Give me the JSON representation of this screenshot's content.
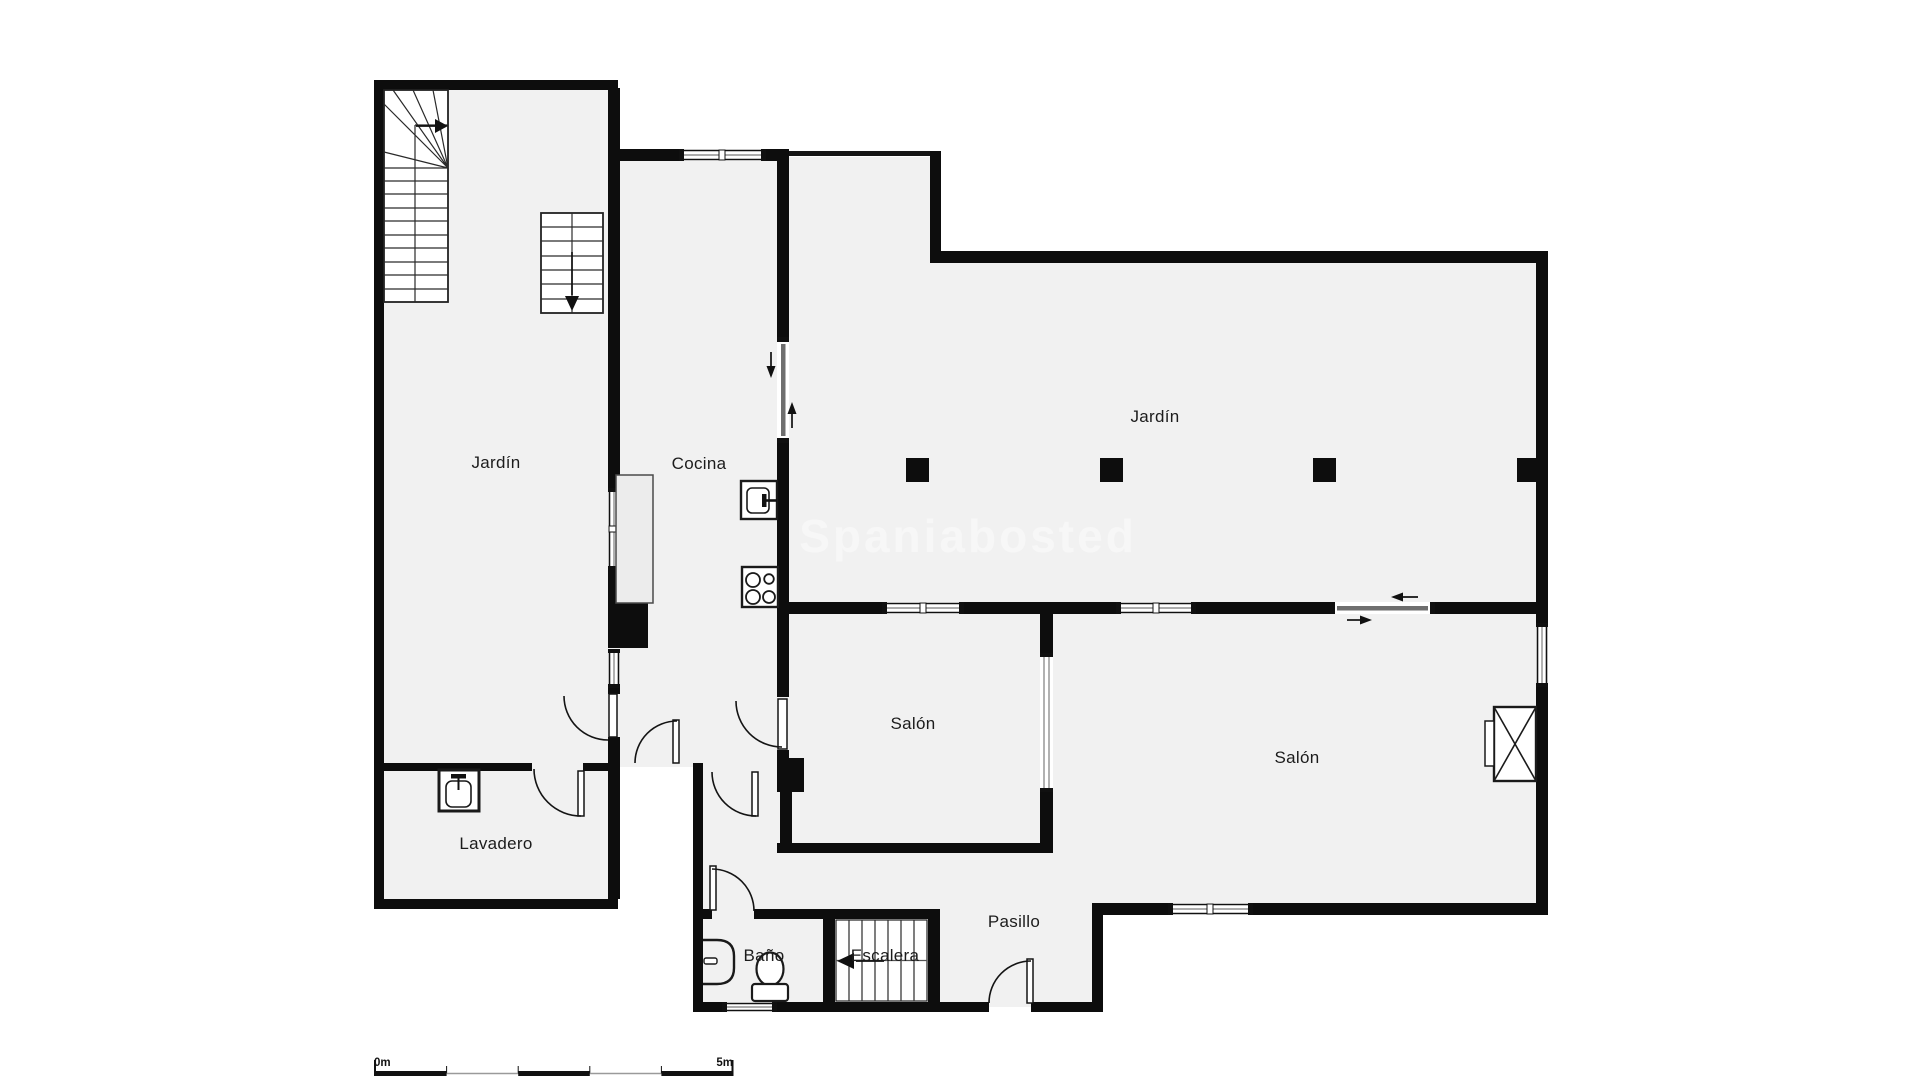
{
  "watermark": {
    "text": "Spaniabosted"
  },
  "scale_bar": {
    "start_label": "0m",
    "end_label": "5m"
  },
  "rooms": {
    "jardin_left": {
      "label": "Jardín"
    },
    "cocina": {
      "label": "Cocina"
    },
    "jardin_main": {
      "label": "Jardín"
    },
    "salon_small": {
      "label": "Salón"
    },
    "salon_main": {
      "label": "Salón"
    },
    "lavadero": {
      "label": "Lavadero"
    },
    "bano": {
      "label": "Baño"
    },
    "escalera": {
      "label": "Escalera"
    },
    "pasillo": {
      "label": "Pasillo"
    }
  },
  "fixtures": [
    "winder-staircase-up",
    "straight-staircase-down",
    "basement-stairs-left",
    "kitchen-counter",
    "kitchen-sink",
    "stove-4-burners",
    "laundry-sink",
    "washbasin",
    "toilet",
    "fireplace-cross",
    "garden-pillars-x4"
  ],
  "colors": {
    "wall": "#0d0d0d",
    "floor": "#f1f1f1",
    "background": "#ffffff",
    "window_line": "#909090",
    "watermark": "#f7f7f7",
    "label": "#1c1c1c"
  }
}
